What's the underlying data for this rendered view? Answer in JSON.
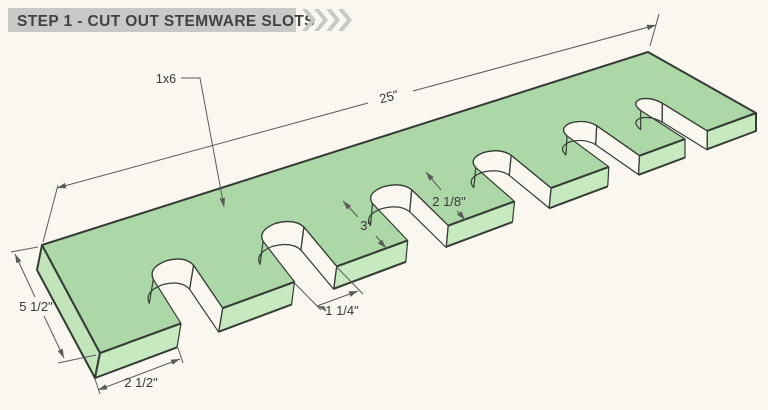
{
  "header": {
    "title": "STEP 1 - CUT OUT STEMWARE SLOTS"
  },
  "part_label": "1x6",
  "dimensions": {
    "board_length": "25\"",
    "board_width": "5 1/2\"",
    "first_finger_width": "2 1/2\"",
    "slot_depth": "3\"",
    "slot_spacing": "2 1/8\"",
    "slot_width": "1 1/4\""
  },
  "colors": {
    "background": "#FAF7F0",
    "header_bar": "#C8C8C6",
    "header_text": "#3F4443",
    "board_top": "#ACD7A6",
    "board_front": "#C7E9BF",
    "board_end": "#C2E4B9",
    "slot_curved_wall": "#D5EFCA",
    "slot_side_wall": "#9ECE9A",
    "edge_line": "#353B35",
    "dimension_line": "#5B5B5B"
  }
}
